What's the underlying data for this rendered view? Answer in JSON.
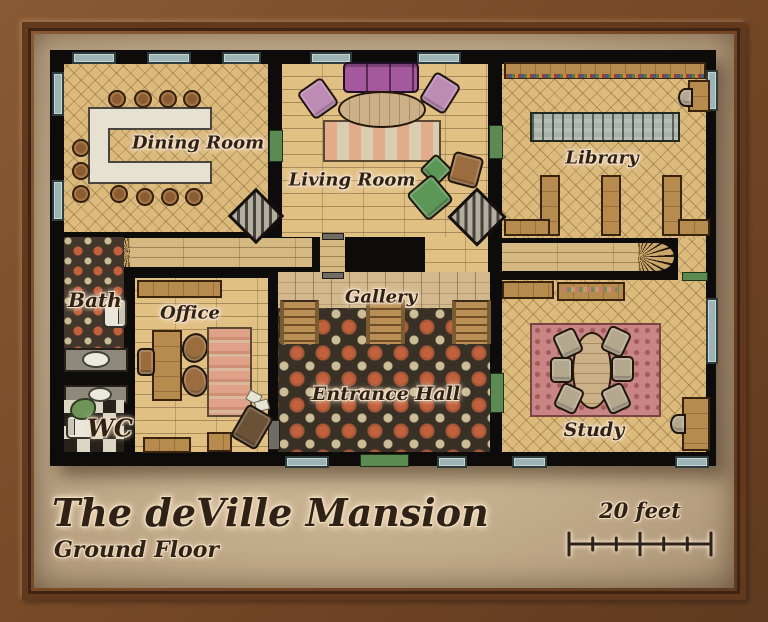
{
  "map": {
    "title": "The deVille Mansion",
    "subtitle": "Ground Floor",
    "scale_label": "20 feet",
    "rooms": {
      "dining": {
        "label": "Dining Room"
      },
      "living": {
        "label": "Living Room"
      },
      "library": {
        "label": "Library"
      },
      "bath": {
        "label": "Bath"
      },
      "office": {
        "label": "Office"
      },
      "gallery": {
        "label": "Gallery"
      },
      "entrance": {
        "label": "Entrance Hall"
      },
      "wc": {
        "label": "WC"
      },
      "study": {
        "label": "Study"
      }
    },
    "colors": {
      "frame_wood": "#7a4b28",
      "parchment": "#c7b190",
      "wall": "#0d0c0a",
      "wood_floor": "#dcba7c",
      "tile_base": "#3a3126",
      "tile_accent": "#c4613d",
      "tile_cream": "#cbbd96",
      "window": "#9db4b6",
      "door": "#5d8a52",
      "sofa": "#a3599b",
      "rug_study": "#c98585",
      "label_ink": "#2e2115",
      "label_halo": "#f3dfc6"
    }
  }
}
